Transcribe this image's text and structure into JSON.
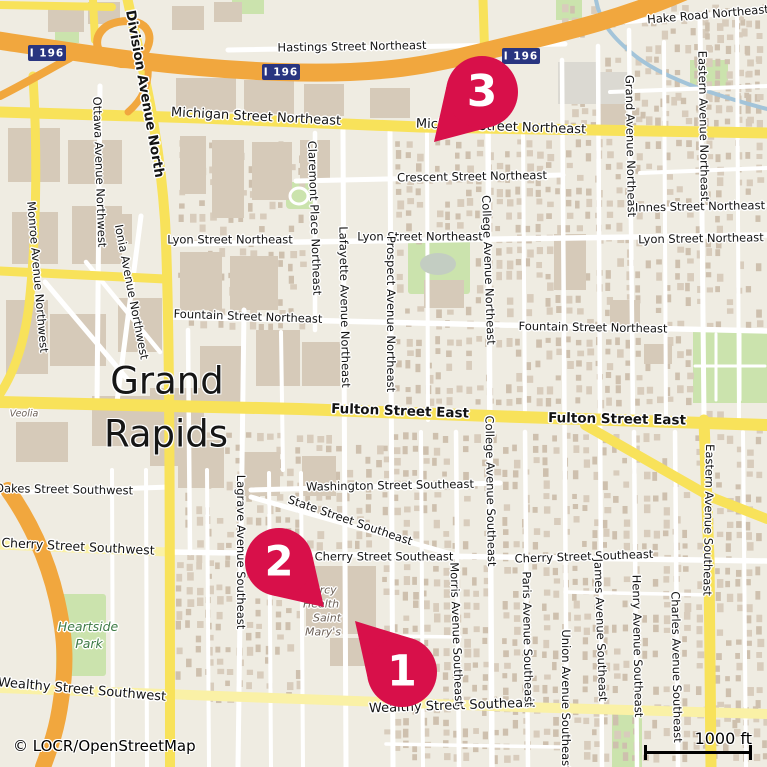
{
  "attribution": {
    "text": "© LOCR/OpenStreetMap"
  },
  "scale_bar": {
    "label": "1000 ft"
  },
  "city": {
    "line1": "Grand",
    "line2": "Rapids"
  },
  "shields": [
    {
      "label": "I 196",
      "x": 47,
      "y": 53
    },
    {
      "label": "I 196",
      "x": 281,
      "y": 72
    },
    {
      "label": "I 196",
      "x": 521,
      "y": 56
    }
  ],
  "markers": [
    {
      "number": "1",
      "cx": 402,
      "cy": 672,
      "r": 35,
      "tx": 355,
      "ty": 621
    },
    {
      "number": "2",
      "cx": 279,
      "cy": 562,
      "r": 34,
      "tx": 324,
      "ty": 607
    },
    {
      "number": "3",
      "cx": 482,
      "cy": 92,
      "r": 36,
      "tx": 434,
      "ty": 142
    }
  ],
  "street_labels": [
    {
      "t": "Hake Road Northeast",
      "x": 708,
      "y": 15,
      "r": -5
    },
    {
      "t": "Hastings Street Northeast",
      "x": 352,
      "y": 47,
      "r": -1
    },
    {
      "t": "Michigan Street Northeast",
      "x": 256,
      "y": 117,
      "r": 3,
      "s": 13
    },
    {
      "t": "Michigan Street Northeast",
      "x": 501,
      "y": 127,
      "r": 2,
      "s": 13
    },
    {
      "t": "Crescent Street Northeast",
      "x": 472,
      "y": 177,
      "r": -1
    },
    {
      "t": "Lyon Street Northeast",
      "x": 230,
      "y": 240,
      "r": 0
    },
    {
      "t": "Lyon Street Northeast",
      "x": 420,
      "y": 237,
      "r": 0
    },
    {
      "t": "Lyon Street Northeast",
      "x": 701,
      "y": 239,
      "r": -1
    },
    {
      "t": "Innes Street Northeast",
      "x": 700,
      "y": 207,
      "r": -1
    },
    {
      "t": "Fountain Street Northeast",
      "x": 248,
      "y": 317,
      "r": 2
    },
    {
      "t": "Fountain Street Northeast",
      "x": 593,
      "y": 328,
      "r": 1
    },
    {
      "t": "Fulton Street East",
      "x": 400,
      "y": 412,
      "r": 2,
      "b": true,
      "s": 13.5
    },
    {
      "t": "Fulton Street East",
      "x": 617,
      "y": 420,
      "r": 1,
      "b": true,
      "s": 13.5
    },
    {
      "t": "Washington Street Southeast",
      "x": 390,
      "y": 486,
      "r": -1
    },
    {
      "t": "State Street Southeast",
      "x": 350,
      "y": 521,
      "r": 19
    },
    {
      "t": "Cherry Street Southwest",
      "x": 78,
      "y": 547,
      "r": 3,
      "s": 12.5
    },
    {
      "t": "Cherry Street Southeast",
      "x": 384,
      "y": 557,
      "r": 0
    },
    {
      "t": "Cherry Street Southeast",
      "x": 584,
      "y": 557,
      "r": -2
    },
    {
      "t": "Oakes Street Southwest",
      "x": 64,
      "y": 490,
      "r": 1
    },
    {
      "t": "Wealthy Street Southwest",
      "x": 82,
      "y": 690,
      "r": 5,
      "s": 13
    },
    {
      "t": "Wealthy Street Southeast",
      "x": 452,
      "y": 706,
      "r": -2,
      "s": 13
    },
    {
      "t": "Division Avenue North",
      "x": 144,
      "y": 94,
      "r": 80,
      "b": true,
      "s": 13.5
    },
    {
      "t": "Ottawa Avenue Northwest",
      "x": 99,
      "y": 172,
      "r": 88
    },
    {
      "t": "Ionia Avenue Northwest",
      "x": 131,
      "y": 292,
      "r": 79
    },
    {
      "t": "Monroe Avenue Northwest",
      "x": 37,
      "y": 277,
      "r": 85
    },
    {
      "t": "Lagrave Avenue Southeast",
      "x": 240,
      "y": 552,
      "r": 90
    },
    {
      "t": "Claremont Place Northeast",
      "x": 314,
      "y": 218,
      "r": 88
    },
    {
      "t": "Lafayette Avenue Northeast",
      "x": 344,
      "y": 307,
      "r": 89
    },
    {
      "t": "Prospect Avenue Northeast",
      "x": 390,
      "y": 314,
      "r": 90
    },
    {
      "t": "College Avenue Northeast",
      "x": 488,
      "y": 270,
      "r": 88
    },
    {
      "t": "College Avenue Southeast",
      "x": 490,
      "y": 491,
      "r": 89
    },
    {
      "t": "Grand Avenue Northeast",
      "x": 630,
      "y": 146,
      "r": 89
    },
    {
      "t": "Eastern Avenue Northeast",
      "x": 703,
      "y": 126,
      "r": 89
    },
    {
      "t": "Eastern Avenue Southeast",
      "x": 708,
      "y": 520,
      "r": 91
    },
    {
      "t": "Morris Avenue Southeast",
      "x": 456,
      "y": 634,
      "r": 88
    },
    {
      "t": "Paris Avenue Southeast",
      "x": 527,
      "y": 639,
      "r": 89
    },
    {
      "t": "Union Avenue Southeast",
      "x": 565,
      "y": 700,
      "r": 90
    },
    {
      "t": "James Avenue Southeast",
      "x": 600,
      "y": 630,
      "r": 88
    },
    {
      "t": "Henry Avenue Southeast",
      "x": 637,
      "y": 646,
      "r": 89
    },
    {
      "t": "Charles Avenue Southeast",
      "x": 676,
      "y": 667,
      "r": 89
    }
  ],
  "place_labels": [
    {
      "t": "Heartside",
      "x": 88,
      "y": 627,
      "c": "park",
      "i": true,
      "s": 12.5
    },
    {
      "t": "Park",
      "x": 89,
      "y": 644,
      "c": "park",
      "i": true,
      "s": 12.5
    },
    {
      "t": "Veolia",
      "x": 24,
      "y": 414,
      "c": "poi",
      "i": true,
      "s": 9.5
    },
    {
      "t": "Mercy",
      "x": 320,
      "y": 590,
      "c": "poi",
      "i": true,
      "s": 11
    },
    {
      "t": "Health",
      "x": 321,
      "y": 604,
      "c": "poi",
      "i": true,
      "s": 11
    },
    {
      "t": "Saint",
      "x": 327,
      "y": 618,
      "c": "poi",
      "i": true,
      "s": 11
    },
    {
      "t": "Mary's",
      "x": 323,
      "y": 632,
      "c": "poi",
      "i": true,
      "s": 11
    }
  ],
  "colors": {
    "background": "#efece2",
    "building": "#d6cab9",
    "park": "#cbe3ad",
    "water": "#a3c4d9",
    "road_primary": "#f8e25a",
    "road_pale": "#faf1a6",
    "motorway": "#f1a73e",
    "pin": "#d8104a",
    "pin_number": "#ffffff",
    "shield_bg": "#293580",
    "shield_text": "#ffffff",
    "park_label": "#3e7b46",
    "poi_label": "#6e6259",
    "label": "#141414"
  }
}
